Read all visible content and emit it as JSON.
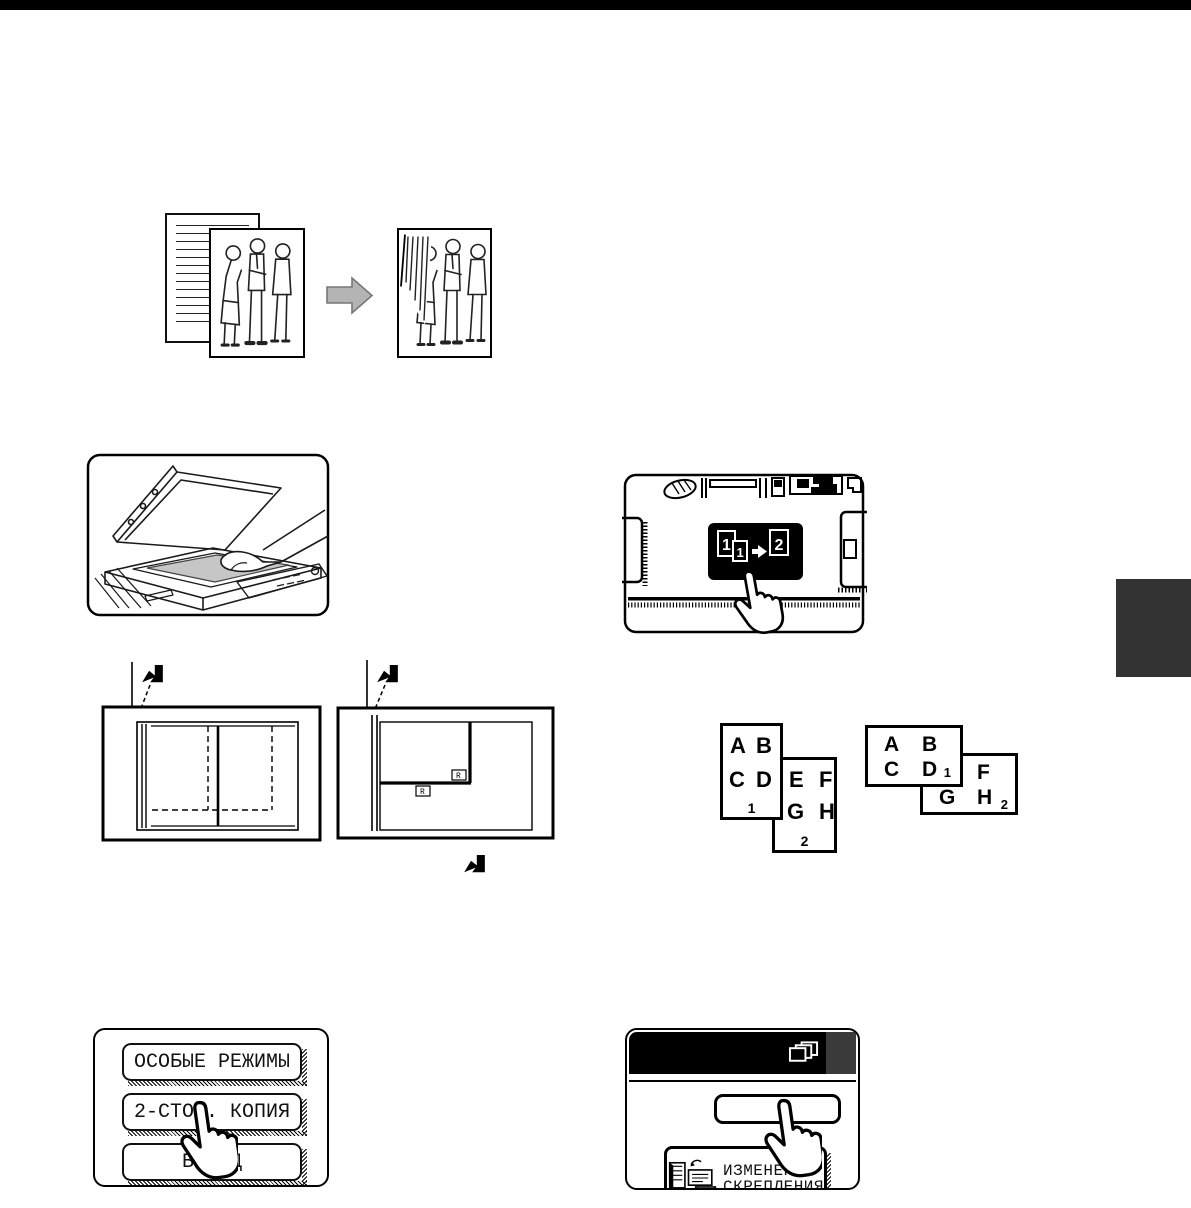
{
  "page": {
    "top_bar_color": "#000000",
    "side_tab_color": "#333333",
    "background": "#ffffff"
  },
  "figures": {
    "originals_arrow_color": "#b4b4b4",
    "copier_original_color": "#c6c6c6"
  },
  "operation_panel": {
    "two_sided_key": {
      "icon": "one-one-to-two-icon",
      "digits": [
        "1",
        "1",
        "2"
      ]
    }
  },
  "placement_diagrams": {
    "r_labels": [
      "R",
      "R"
    ]
  },
  "page_order": {
    "portrait": {
      "sheet1": {
        "letters": [
          "A",
          "B",
          "C",
          "D"
        ],
        "number": "1"
      },
      "sheet2": {
        "letters": [
          "E",
          "F",
          "G",
          "H"
        ],
        "number": "2"
      }
    },
    "landscape": {
      "sheet1": {
        "letters": [
          "A",
          "B",
          "C",
          "D"
        ],
        "number": "1"
      },
      "sheet2": {
        "letters": [
          "E",
          "F",
          "G",
          "H"
        ],
        "number": "2"
      }
    }
  },
  "touch_panel_left": {
    "buttons": [
      {
        "label": "ОСОБЫЕ РЕЖИМЫ"
      },
      {
        "label": "2-СТОР. КОПИЯ"
      },
      {
        "label": "ВЫВОД"
      }
    ]
  },
  "touch_panel_right": {
    "header_icon": "copies-icon",
    "binding_button": {
      "icon": "binding-change-icon",
      "label_line1": "ИЗМЕНЕНИЕ",
      "label_line2": "СКРЕПЛЕНИЯ"
    }
  }
}
